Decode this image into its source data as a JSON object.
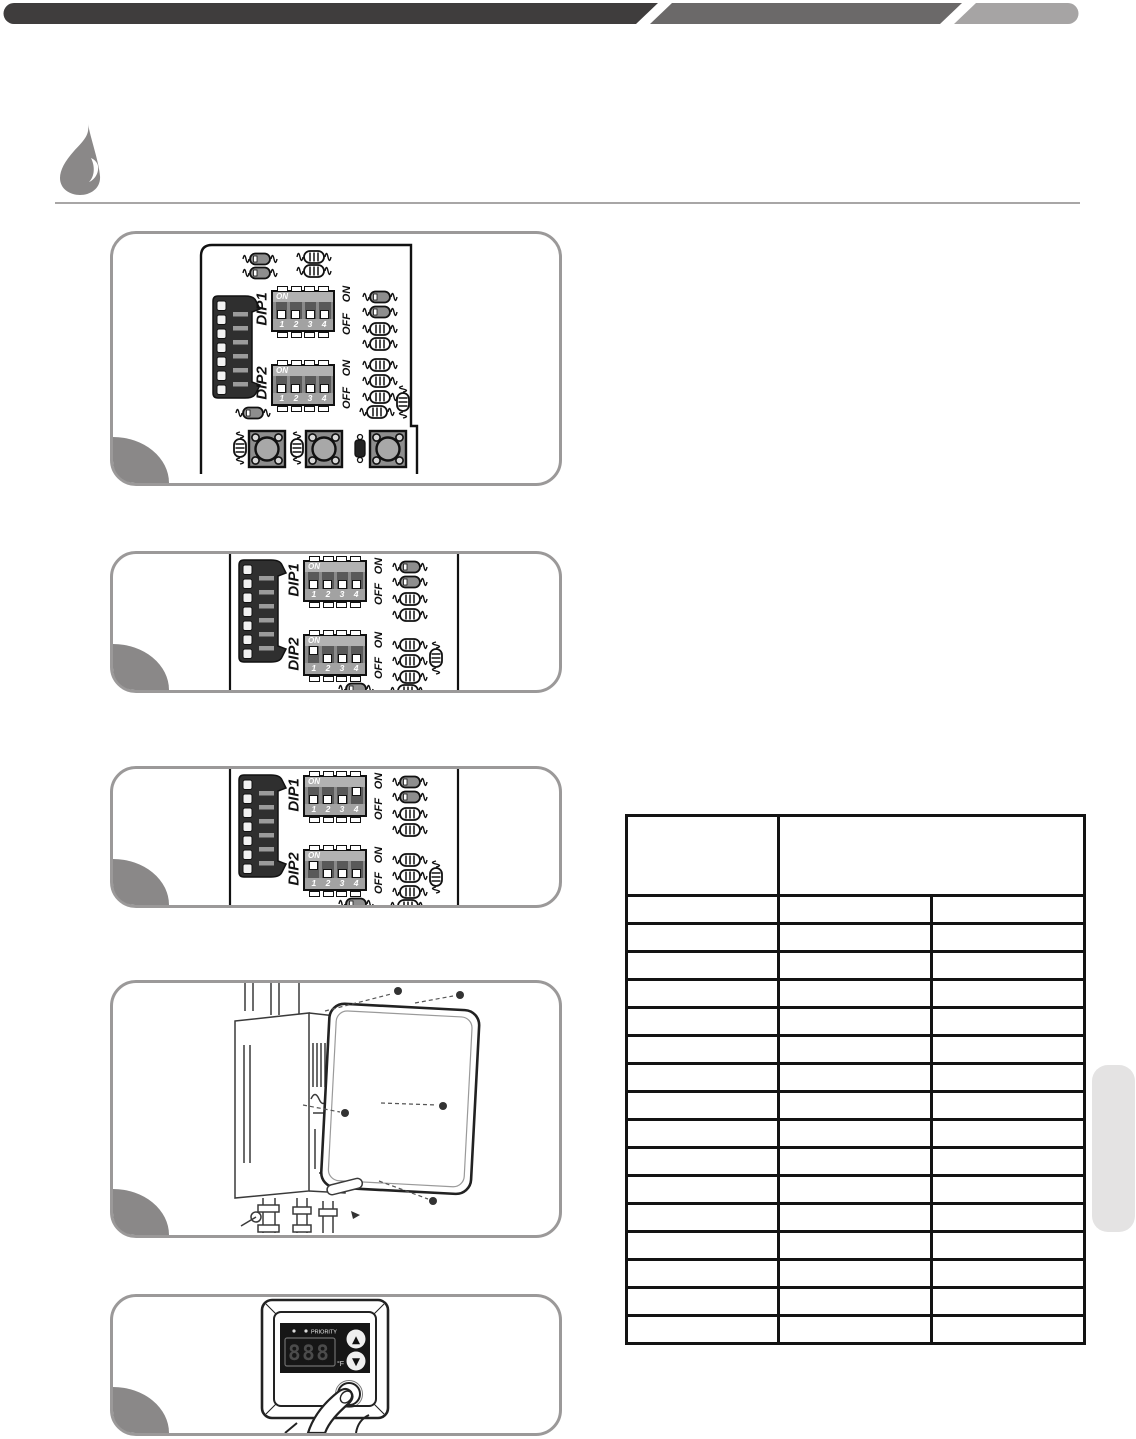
{
  "header_bar": {
    "colors": {
      "dark": "#3f3d3d",
      "mid": "#6b6969",
      "light": "#a6a4a4"
    }
  },
  "section_icon": {
    "name": "water-drop-icon",
    "color": "#8a8888"
  },
  "divider_color": "#a8a6a6",
  "dip_common": {
    "dip1_label": "DIP1",
    "dip2_label": "DIP2",
    "on_label": "ON",
    "off_label": "OFF",
    "numbers_text": "1 2 3 4"
  },
  "figures": {
    "fig1": {
      "dip1_states": [
        "off",
        "off",
        "off",
        "off"
      ],
      "dip2_states": [
        "off",
        "off",
        "off",
        "off"
      ]
    },
    "fig2": {
      "dip1_states": [
        "off",
        "off",
        "off",
        "off"
      ],
      "dip2_states": [
        "on",
        "off",
        "off",
        "off"
      ]
    },
    "fig3": {
      "dip1_states": [
        "off",
        "off",
        "off",
        "on"
      ],
      "dip2_states": [
        "on",
        "off",
        "off",
        "off"
      ]
    }
  },
  "controller": {
    "priority_label": "PRIORITY",
    "display_value": "888",
    "unit_label": "°F",
    "up_symbol": "▲",
    "down_symbol": "▼"
  },
  "table": {
    "header": [
      "",
      ""
    ],
    "rows": [
      [
        "",
        "",
        ""
      ],
      [
        "",
        "",
        ""
      ],
      [
        "",
        "",
        ""
      ],
      [
        "",
        "",
        ""
      ],
      [
        "",
        "",
        ""
      ],
      [
        "",
        "",
        ""
      ],
      [
        "",
        "",
        ""
      ],
      [
        "",
        "",
        ""
      ],
      [
        "",
        "",
        ""
      ],
      [
        "",
        "",
        ""
      ],
      [
        "",
        "",
        ""
      ],
      [
        "",
        "",
        ""
      ],
      [
        "",
        "",
        ""
      ],
      [
        "",
        "",
        ""
      ],
      [
        "",
        "",
        ""
      ],
      [
        "",
        "",
        ""
      ]
    ]
  },
  "side_tab": {
    "color": "#e4e3e3"
  }
}
